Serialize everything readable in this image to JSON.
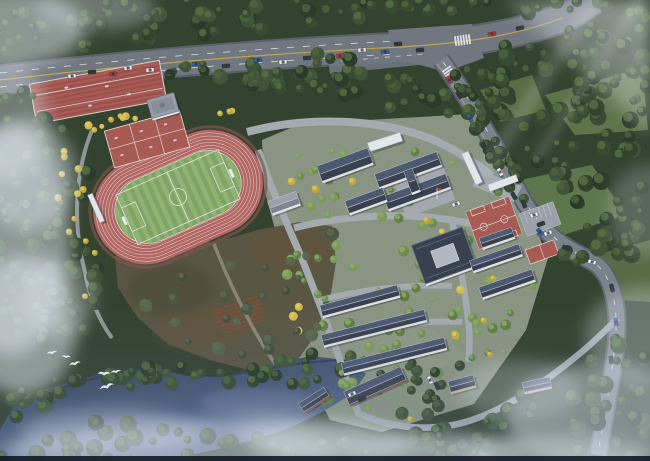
{
  "meta": {
    "title": "Aerial architectural rendering of a school campus",
    "view": "birdseye"
  },
  "palette": {
    "forestBase": "#2e3b26",
    "grassLight": "#5d7744",
    "grassPale": "#6e8a50",
    "campusGround": "#939a84",
    "roadMajor": "#6e737a",
    "roadCasing": "#565b62",
    "roadMinor": "#a4a9ae",
    "roadEast": "#787e86",
    "pathDirt": "#8d8775",
    "laneYellow": "#c7a43c",
    "laneWhite": "#eceef0",
    "trackRed": "#b4625c",
    "trackEdge": "#7e4f48",
    "trackLine": "#efe9e7",
    "fieldGreen": "#7ea35e",
    "fieldStripe": "#8fb36c",
    "pitchLine": "#e9ece9",
    "courtRed": "#a8554c",
    "courtDark": "#8f463f",
    "courtLine": "#e8e5df",
    "roofDark": "#333a48",
    "roofLight": "#49536a",
    "roofRidge": "#c6ccd8",
    "wallWhite": "#e6e7e3",
    "brick": "#7e5440",
    "tanWall": "#c9b98a",
    "gymCourtyard": "#b3b8bf",
    "farmBase": "#55503a",
    "farmDark": "#46452f",
    "farmBrown": "#6b4e31",
    "terraceRed": "#7c4a2e",
    "water": "#2b374f",
    "waterLight": "#5a6d8f",
    "mist": "#e3eaf4",
    "ginkgo": "#d2ba41",
    "bird": "#f4f7fa",
    "carWhite": "#eef0f2",
    "carDark": "#2c3138",
    "carRed": "#b33430",
    "carBlue": "#2f5f9e",
    "bottomBar": "#151c28",
    "haze": "#9fb4d6"
  },
  "scene": {
    "features": [
      "arterial road",
      "road intersection",
      "crosswalks",
      "terraced sports courts",
      "practice courts",
      "running track",
      "football field",
      "teaching buildings",
      "campus plaza",
      "flagpole",
      "entrance gate",
      "gymnasium",
      "basketball courts",
      "parking lot",
      "dormitory rows",
      "brick workshop",
      "farmland",
      "lake",
      "egrets",
      "forest",
      "mist clouds",
      "sunlight rays"
    ],
    "counts": {
      "egrets": 6,
      "basketball_courts": 2,
      "practice_courts": 6,
      "track_lanes": 8,
      "dormitory_rows": 4,
      "terrace_rows": 8
    }
  }
}
